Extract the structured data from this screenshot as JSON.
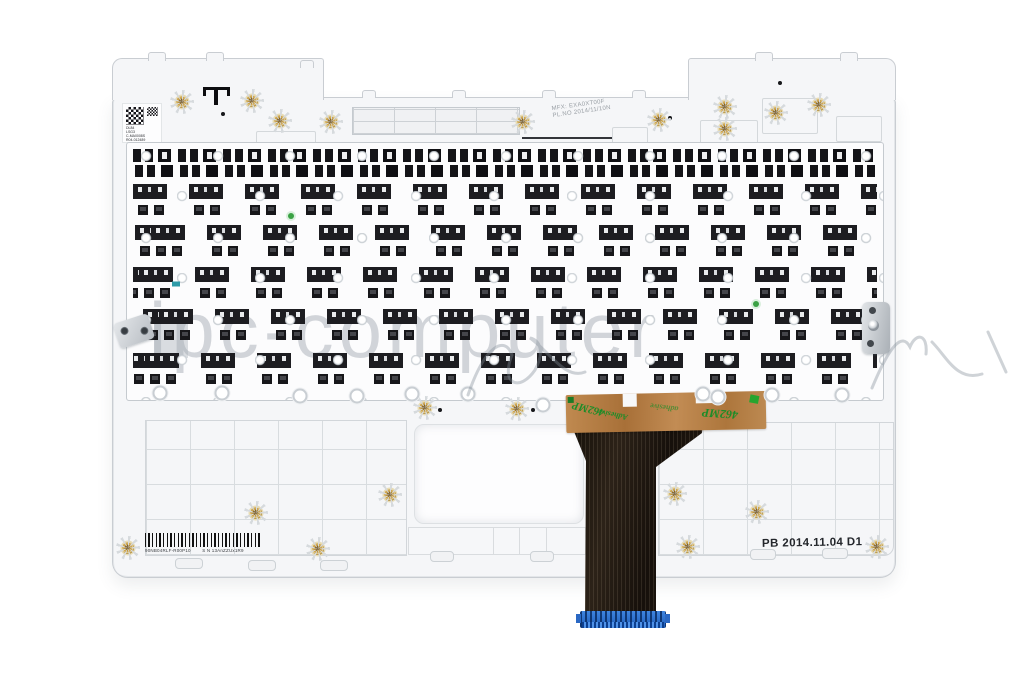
{
  "scene": {
    "background": "#ffffff",
    "subject": "white laptop palmrest top-case rear view with keyboard back, adhesive tape and ribbon cable"
  },
  "watermark": {
    "text": "ipc-computer"
  },
  "top_label": {
    "line1": "MFX: EXA0XT00F",
    "line2": "PL.NO 2014/11/10N"
  },
  "qr_label": {
    "lines": [
      "DL84",
      "LSG3",
      "C-MA0008S",
      "R04-012489"
    ]
  },
  "barcode_label": {
    "left_text": "90NB04RLF-R00P10",
    "right_text": "S N 13AnZZUx1R9"
  },
  "stamp": {
    "text": "PB 2014.11.04 D1"
  },
  "tape": {
    "text_mp": "462MP",
    "text_adhesive": "Adhesive",
    "text_adhesive_small": "adhesive",
    "text_mp_right": "462MP"
  },
  "colors": {
    "brass": "#c9a04e",
    "tape": "#b5793f",
    "tape_text": "#1d8f2b",
    "cable": "#221a14",
    "connector": "#2a6fd2",
    "plastic": "#f5f6f8",
    "edge": "#c9cdd2",
    "watermark": "rgba(150,158,166,0.42)"
  },
  "positions": {
    "brass_posts": [
      [
        182,
        102
      ],
      [
        252,
        101
      ],
      [
        280,
        121
      ],
      [
        331,
        122
      ],
      [
        523,
        122
      ],
      [
        659,
        120
      ],
      [
        725,
        107
      ],
      [
        725,
        129
      ],
      [
        776,
        113
      ],
      [
        819,
        105
      ],
      [
        425,
        408
      ],
      [
        517,
        409
      ],
      [
        256,
        513
      ],
      [
        390,
        495
      ],
      [
        675,
        494
      ],
      [
        757,
        512
      ],
      [
        128,
        548
      ],
      [
        318,
        549
      ],
      [
        688,
        547
      ],
      [
        877,
        547
      ]
    ],
    "bosses": [
      [
        160,
        393
      ],
      [
        222,
        393
      ],
      [
        300,
        396
      ],
      [
        357,
        396
      ],
      [
        412,
        394
      ],
      [
        468,
        394
      ],
      [
        543,
        405
      ],
      [
        703,
        394
      ],
      [
        772,
        395
      ],
      [
        842,
        395
      ],
      [
        718,
        397
      ]
    ],
    "feet": [
      [
        175,
        558,
        26,
        9
      ],
      [
        248,
        560,
        26,
        9
      ],
      [
        320,
        560,
        26,
        9
      ],
      [
        430,
        551,
        22,
        9
      ],
      [
        530,
        551,
        22,
        9
      ],
      [
        606,
        555,
        24,
        9
      ],
      [
        750,
        549,
        24,
        9
      ],
      [
        822,
        548,
        24,
        9
      ]
    ],
    "bumps": [
      [
        148,
        52,
        16,
        8
      ],
      [
        206,
        52,
        16,
        8
      ],
      [
        300,
        60,
        12,
        7
      ],
      [
        755,
        52,
        16,
        8
      ],
      [
        840,
        52,
        16,
        8
      ],
      [
        362,
        90,
        12,
        7
      ],
      [
        452,
        90,
        12,
        7
      ],
      [
        542,
        90,
        12,
        7
      ],
      [
        632,
        90,
        12,
        7
      ]
    ],
    "dots": [
      [
        223,
        114
      ],
      [
        440,
        410
      ],
      [
        533,
        410
      ],
      [
        780,
        83
      ],
      [
        670,
        118
      ],
      [
        594,
        489
      ]
    ],
    "outlines": [
      [
        256,
        131,
        58,
        32
      ],
      [
        312,
        144,
        62,
        20
      ],
      [
        700,
        120,
        56,
        34
      ],
      [
        762,
        98,
        54,
        34
      ],
      [
        836,
        116,
        44,
        24
      ],
      [
        612,
        127,
        34,
        16
      ]
    ]
  }
}
